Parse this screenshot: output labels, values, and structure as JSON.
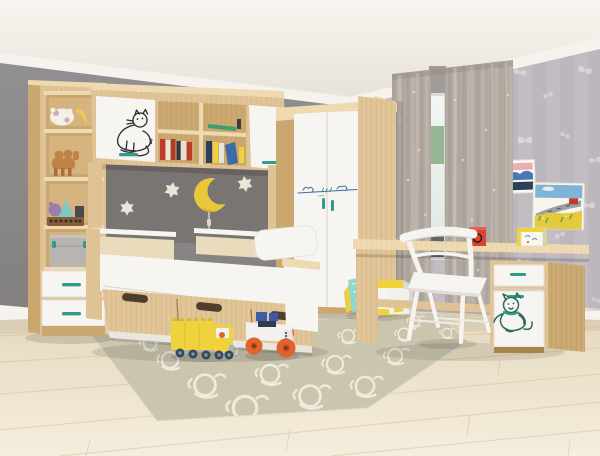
{
  "scene": {
    "description": "Showroom photograph of a children's bedroom furniture set in light oak and white: tall open shelf tower with drawers, wall bridge cabinet with cat-doodle door and book shelves, grey accent wall with a yellow crescent moon lamp and cream stars, corner wardrobe with blue doodle strip, single bed with beige padded back panels and under-bed drawers, grey floral curtains at a window, light oak desk with white chair and cat-doodle pedestal, patterned beige rug and toy trucks on a whitewashed wood floor, children's drawings pinned to butterfly wallpaper.",
    "style": "furniture product photo"
  },
  "palette": {
    "wall-gray": "#8b898c",
    "wall-accent": "#7a7472",
    "cornice": "#f6f3ee",
    "wallpaper-base": "#bcb6bd",
    "wallpaper-stripe": "#c6c0c7",
    "wallpaper-motif": "#e5e0e5",
    "curtain-base": "#b3aaa2",
    "window-green": "#85ab82",
    "window-dark": "#5d6862",
    "floor-seam": "#d2c2a4",
    "rug-base": "#cbc5ae",
    "rug-pattern": "#f2eee1",
    "wood-face": "#e0c394",
    "wood-dark": "#c9a76e",
    "wood-deep": "#a9844e",
    "wood-edge": "#eed9b0",
    "furniture-white": "#f7f5f1",
    "white-shade": "#e9e5df",
    "handle-teal": "#2f9b8a",
    "pad-beige": "#e9dcbc",
    "moon-yellow": "#e9c73c",
    "star-cream": "#eae5d8",
    "cat-ink": "#2b2b2b",
    "cat-teal": "#2d6a58",
    "doodle-blue": "#3c6ca8",
    "toy-red": "#d84431",
    "toy-yellow": "#f0d23c",
    "toy-orange": "#e0622c",
    "toy-navy": "#35495e",
    "toy-blue": "#3c5ca6",
    "box-gray": "#b8b5b0",
    "board-teal": "#8fd8d2"
  },
  "objects": {
    "left-shelf-tower": "open shelving tower with toys, grey storage box and two white drawers with teal handles",
    "wall-bridge-cabinet": "wall bridge cabinet: white door with black cat doodle, open shelves with books, white door",
    "accent-wall-decor": "yellow crescent moon lamp with cord and three cream six-point stars on dark grey wall",
    "corner-wardrobe": "white two-door corner wardrobe with blue doodle strip and teal handles",
    "bed": "single bed with beige padded back panels, white pillow and wood under-bed drawers with scoop cutouts",
    "window-curtains": "grey floral curtains with narrow window gap",
    "wall-art": "two children's drawings pinned to butterfly wallpaper",
    "desk": "light oak desk with pedestal cabinet: white drawer, white door with teal cat doodle",
    "chair": "white wooden chair",
    "rug": "beige rug with white scroll-ring pattern",
    "floor-toys": "yellow toy truck and white monster truck with orange wheels",
    "desk-toys": "red cube toy and yellow box",
    "wardrobe-foot-items": "folded teal play mat and yellow-white storage box"
  }
}
